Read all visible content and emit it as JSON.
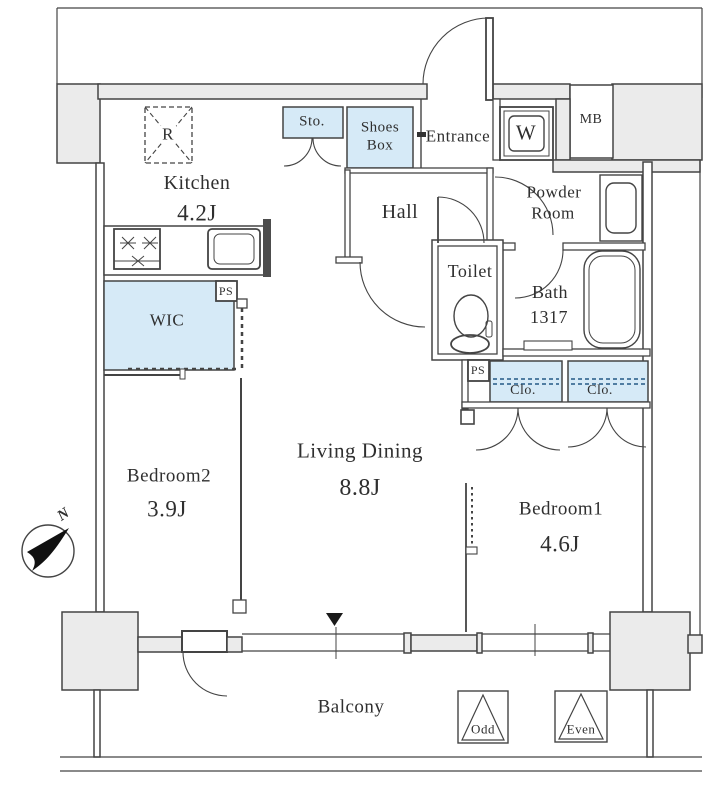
{
  "title": "Apartment floor plan 1LDK+WIC",
  "colors": {
    "wall_fill": "#ebebeb",
    "closet_fill": "#d6eaf7",
    "line": "#444444",
    "dash_blue": "#3d6e96",
    "text": "#2f2f2f",
    "marker": "#1a1a1a"
  },
  "rooms": {
    "kitchen": {
      "name": "Kitchen",
      "size": "4.2J"
    },
    "living": {
      "name": "Living Dining",
      "size": "8.8J"
    },
    "bedroom1": {
      "name": "Bedroom1",
      "size": "4.6J"
    },
    "bedroom2": {
      "name": "Bedroom2",
      "size": "3.9J"
    },
    "hall": {
      "name": "Hall"
    },
    "entrance": {
      "name": "Entrance"
    },
    "powder_room": {
      "line1": "Powder",
      "line2": "Room"
    },
    "toilet": {
      "name": "Toilet"
    },
    "bath": {
      "name": "Bath",
      "size": "1317"
    },
    "wic": {
      "name": "WIC"
    },
    "balcony": {
      "name": "Balcony"
    },
    "storage": {
      "name": "Sto."
    },
    "shoes_box": {
      "line1": "Shoes",
      "line2": "Box"
    }
  },
  "labels": {
    "refrigerator": "R",
    "washer": "W",
    "meter_box": "MB",
    "pipe_space": "PS",
    "closet": "Clo.",
    "odd_floor_hatch": "Odd",
    "even_floor_hatch": "Even",
    "north": "N"
  }
}
